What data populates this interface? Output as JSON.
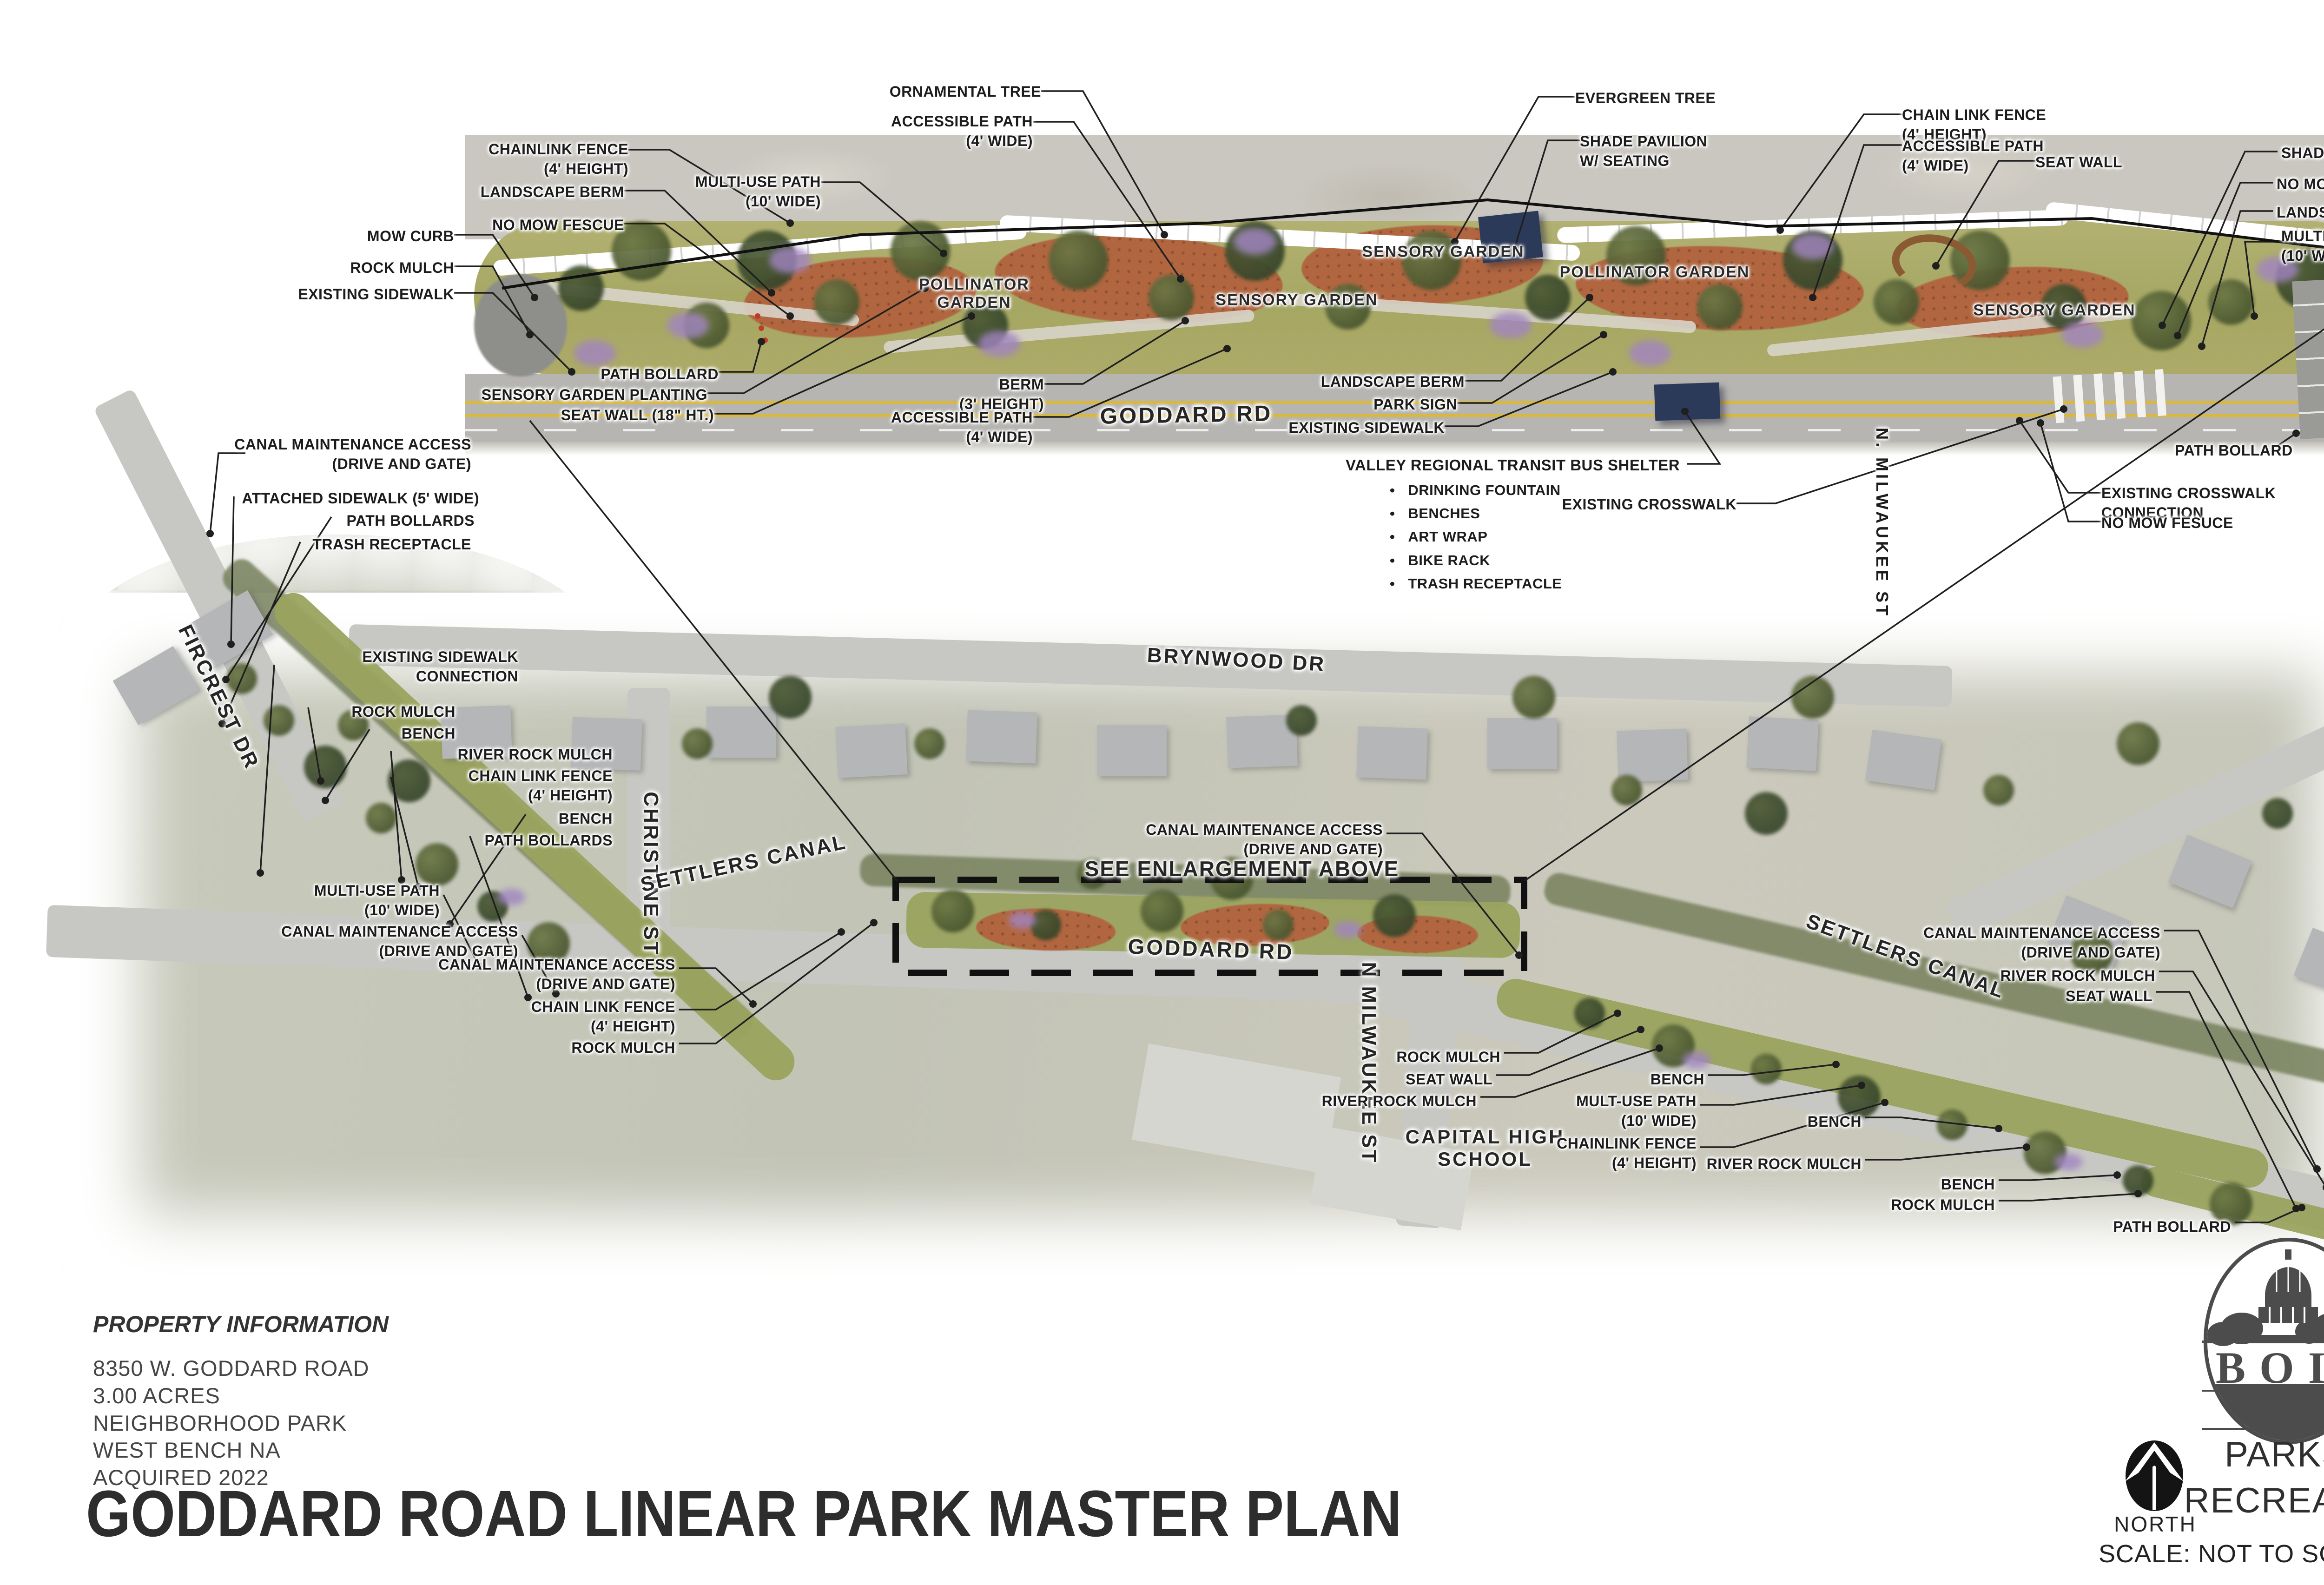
{
  "sheet": {
    "title": "GODDARD ROAD LINEAR PARK MASTER PLAN",
    "property": {
      "heading": "PROPERTY INFORMATION",
      "lines": "8350 W. GODDARD ROAD\n3.00 ACRES\nNEIGHBORHOOD PARK\nWEST BENCH NA\nACQUIRED 2022"
    },
    "branding": {
      "city": "BOISE",
      "tagline": "CITY OF TREES",
      "department": "PARKS &\nRECREATION",
      "north": "NORTH",
      "scale": "SCALE: NOT TO SCALE"
    }
  },
  "enlargement": {
    "road": "GODDARD RD",
    "gardens": [
      "POLLINATOR\nGARDEN",
      "SENSORY GARDEN",
      "SENSORY GARDEN",
      "POLLINATOR GARDEN",
      "SENSORY GARDEN"
    ],
    "callouts": [
      "ORNAMENTAL TREE",
      "ACCESSIBLE PATH\n(4' WIDE)",
      "CHAINLINK FENCE\n(4' HEIGHT)",
      "LANDSCAPE BERM",
      "MULTI-USE PATH\n(10' WIDE)",
      "NO MOW FESCUE",
      "MOW CURB",
      "ROCK MULCH",
      "EXISTING SIDEWALK",
      "PATH BOLLARD",
      "SENSORY GARDEN PLANTING",
      "SEAT WALL (18\" HT.)",
      "BERM\n(3' HEIGHT)",
      "ACCESSIBLE PATH\n(4' WIDE)",
      "LANDSCAPE BERM",
      "PARK SIGN",
      "EXISTING SIDEWALK",
      "EXISTING CROSSWALK",
      "EVERGREEN TREE",
      "SHADE PAVILION\nW/ SEATING",
      "CHAIN LINK FENCE\n(4' HEIGHT)",
      "ACCESSIBLE PATH\n(4' WIDE)",
      "SEAT WALL",
      "SHADE TREE",
      "NO MOW FESCUE",
      "LANDSCAPE BERM",
      "MULTI-USE PATH\n(10' WIDE)",
      "PATH BOLLARD",
      "EXISTING CROSSWALK\nCONNECTION",
      "NO MOW FESUCE",
      "N. MILWAUKEE ST"
    ],
    "bus_shelter": {
      "label": "VALLEY REGIONAL TRANSIT BUS SHELTER",
      "items": [
        "DRINKING FOUNTAIN",
        "BENCHES",
        "ART WRAP",
        "BIKE RACK",
        "TRASH RECEPTACLE"
      ]
    }
  },
  "map": {
    "streets": [
      "BRYNWOOD DR",
      "FIRCREST DR",
      "CHRISTINE ST",
      "SETTLERS CANAL",
      "SETTLERS CANAL",
      "GODDARD RD",
      "N MILWAUKEE ST"
    ],
    "labels": {
      "see_enlargement": "SEE ENLARGEMENT ABOVE",
      "school": "CAPITAL HIGH\nSCHOOL"
    },
    "callouts": [
      "CANAL MAINTENANCE ACCESS\n(DRIVE AND GATE)",
      "ATTACHED SIDEWALK (5' WIDE)",
      "PATH BOLLARDS",
      "TRASH RECEPTACLE",
      "EXISTING SIDEWALK\nCONNECTION",
      "ROCK MULCH",
      "BENCH",
      "RIVER ROCK MULCH",
      "CHAIN LINK FENCE\n(4' HEIGHT)",
      "BENCH",
      "PATH BOLLARDS",
      "MULTI-USE PATH\n(10' WIDE)",
      "CANAL MAINTENANCE ACCESS\n(DRIVE AND GATE)",
      "CANAL MAINTENANCE ACCESS\n(DRIVE AND GATE)",
      "CHAIN LINK FENCE\n(4' HEIGHT)",
      "ROCK MULCH",
      "CANAL MAINTENANCE ACCESS\n(DRIVE AND GATE)",
      "ROCK MULCH",
      "SEAT WALL",
      "RIVER ROCK MULCH",
      "BENCH",
      "MULT-USE PATH\n(10' WIDE)",
      "CHAINLINK FENCE\n(4' HEIGHT)",
      "BENCH",
      "RIVER ROCK MULCH",
      "BENCH",
      "ROCK MULCH",
      "PATH BOLLARD",
      "CANAL MAINTENANCE ACCESS\n(DRIVE AND GATE)",
      "RIVER ROCK MULCH",
      "SEAT WALL"
    ]
  },
  "colors": {
    "leader": "#1f1f1f",
    "park_green": "#a9ab68",
    "garden_bed": "#b2643f",
    "road_gray": "#b6b5b1",
    "center_line_yellow": "#d9b840",
    "logo_gray": "#4c4c4c"
  }
}
